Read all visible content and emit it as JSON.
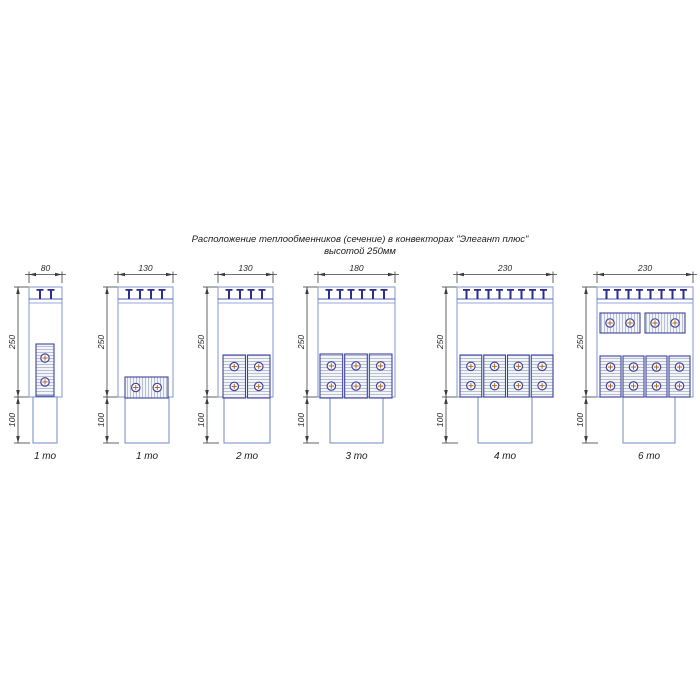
{
  "title": {
    "line1": "Расположение теплообменников (сечение) в конвекторах \"Элегант плюс\"",
    "line2": "высотой 250мм"
  },
  "colors": {
    "body_stroke": "#8fa0cf",
    "duct_stroke": "#7f93c8",
    "band_line_dark": "#5560b0",
    "band_line_light": "#9aa9da",
    "tee": "#2b2e8f",
    "block_stroke": "#3d43a0",
    "block_fill": "#f4f5f8",
    "hatch": "#a9b2c8",
    "circle_stroke": "#3d43a0",
    "cross": "#b5622d",
    "dim": "#3c3c3c",
    "background": "#ffffff"
  },
  "shared": {
    "height_label": "250",
    "duct_label": "100",
    "box_top": 287,
    "box_height": 110,
    "duct_height": 46,
    "caption_y": 459,
    "dim_top_line_y": 274.5,
    "band_offsets": [
      12,
      16
    ],
    "tee_spacing": 11,
    "dim_left_offset": 11
  },
  "diagrams": [
    {
      "caption": "1 то",
      "width_label": "80",
      "box_x": 29,
      "box_w": 33,
      "duct_x": 33,
      "duct_w": 24,
      "tees": 2,
      "groups": [
        {
          "orient": "vertical",
          "count": 1,
          "x": 36,
          "y": 344,
          "w": 18,
          "h": 52,
          "gap": 2
        }
      ]
    },
    {
      "caption": "1 то",
      "width_label": "130",
      "box_x": 118,
      "box_w": 55,
      "duct_x": 125,
      "duct_w": 44,
      "tees": 4,
      "groups": [
        {
          "orient": "horizontal",
          "count": 1,
          "x": 125,
          "y": 377,
          "w": 43,
          "h": 21,
          "gap": 2
        }
      ]
    },
    {
      "caption": "2 то",
      "width_label": "130",
      "box_x": 218,
      "box_w": 55,
      "duct_x": 224,
      "duct_w": 46,
      "tees": 4,
      "groups": [
        {
          "orient": "vertical",
          "count": 2,
          "x": 223,
          "y": 355,
          "w": 47,
          "h": 43,
          "gap": 2
        }
      ]
    },
    {
      "caption": "3 то",
      "width_label": "180",
      "box_x": 318,
      "box_w": 77,
      "duct_x": 330,
      "duct_w": 53,
      "tees": 6,
      "groups": [
        {
          "orient": "vertical",
          "count": 3,
          "x": 320,
          "y": 354,
          "w": 72,
          "h": 44,
          "gap": 2
        }
      ]
    },
    {
      "caption": "4 то",
      "width_label": "230",
      "box_x": 457,
      "box_w": 96,
      "duct_x": 478,
      "duct_w": 54,
      "tees": 8,
      "groups": [
        {
          "orient": "vertical",
          "count": 4,
          "x": 460,
          "y": 355,
          "w": 93,
          "h": 42,
          "gap": 2
        }
      ]
    },
    {
      "caption": "6 то",
      "width_label": "230",
      "box_x": 597,
      "box_w": 96,
      "duct_x": 623,
      "duct_w": 52,
      "tees": 8,
      "groups": [
        {
          "orient": "horizontal",
          "count": 2,
          "x": 600,
          "y": 313,
          "w": 85,
          "h": 20,
          "gap": 5
        },
        {
          "orient": "vertical",
          "count": 4,
          "x": 600,
          "y": 356,
          "w": 90,
          "h": 41,
          "gap": 2
        }
      ]
    }
  ]
}
